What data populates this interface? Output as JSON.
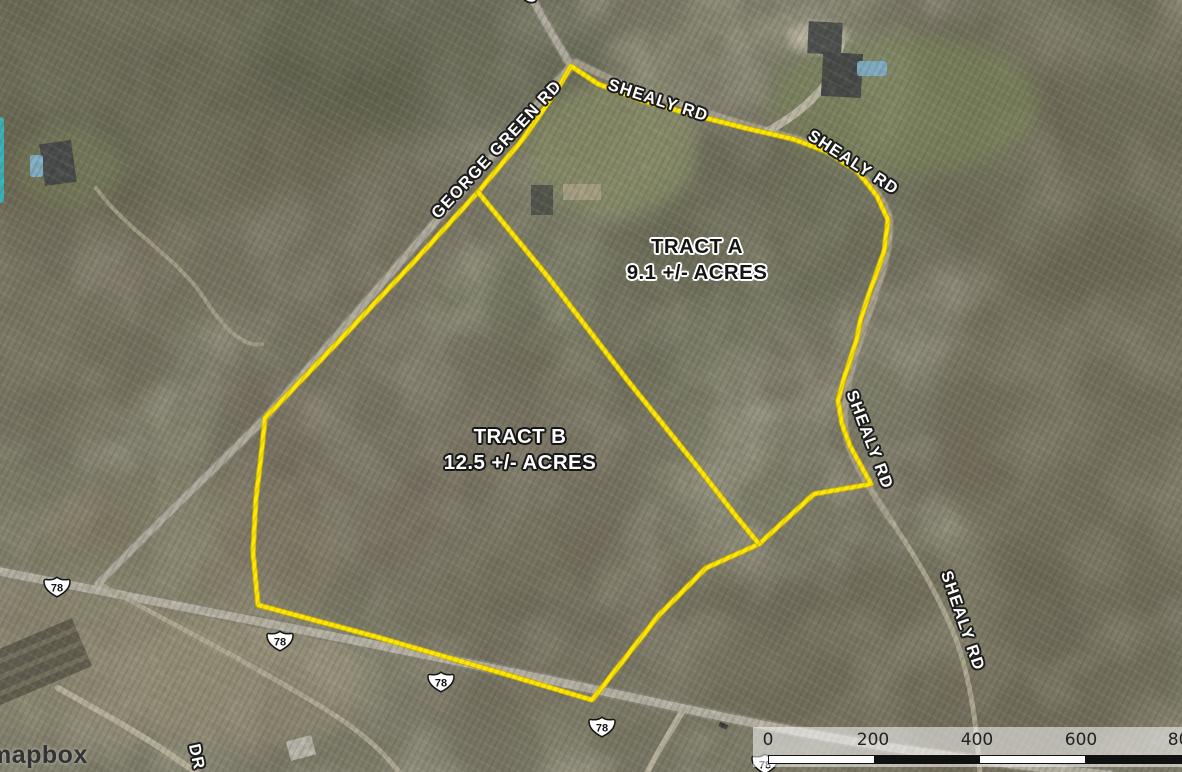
{
  "map": {
    "attribution": {
      "brand": "mapbox"
    },
    "tracts": {
      "a": {
        "name": "TRACT A",
        "acreage": "9.1 +/- ACRES"
      },
      "b": {
        "name": "TRACT B",
        "acreage": "12.5 +/- ACRES"
      }
    },
    "road_labels": {
      "shealy": "SHEALY RD",
      "george_green": "GEORGE GREEN RD",
      "dr_partial": "DR",
      "top_partial": "G"
    },
    "route_shield": "78",
    "scale_bar": {
      "ticks": [
        "0",
        "200",
        "400",
        "600",
        "800"
      ]
    },
    "boundary_color": "#FFE604",
    "boundary_casing_color": "#C9B500",
    "boundaries": {
      "outer": [
        [
          571,
          66
        ],
        [
          598,
          84
        ],
        [
          640,
          100
        ],
        [
          690,
          114
        ],
        [
          745,
          128
        ],
        [
          793,
          139
        ],
        [
          828,
          152
        ],
        [
          858,
          172
        ],
        [
          877,
          196
        ],
        [
          888,
          220
        ],
        [
          884,
          252
        ],
        [
          871,
          288
        ],
        [
          861,
          318
        ],
        [
          856,
          342
        ],
        [
          845,
          375
        ],
        [
          838,
          400
        ],
        [
          842,
          424
        ],
        [
          850,
          446
        ],
        [
          860,
          464
        ],
        [
          871,
          484
        ],
        [
          814,
          494
        ],
        [
          759,
          544
        ],
        [
          706,
          568
        ],
        [
          659,
          615
        ],
        [
          592,
          700
        ],
        [
          498,
          672
        ],
        [
          377,
          637
        ],
        [
          258,
          605
        ],
        [
          253,
          552
        ],
        [
          256,
          498
        ],
        [
          262,
          448
        ],
        [
          265,
          418
        ],
        [
          337,
          343
        ],
        [
          410,
          266
        ],
        [
          478,
          192
        ],
        [
          523,
          139
        ],
        [
          557,
          90
        ],
        [
          571,
          66
        ]
      ],
      "divider": [
        [
          478,
          192
        ],
        [
          548,
          277
        ],
        [
          628,
          381
        ],
        [
          700,
          470
        ],
        [
          736,
          516
        ],
        [
          759,
          544
        ]
      ]
    }
  }
}
